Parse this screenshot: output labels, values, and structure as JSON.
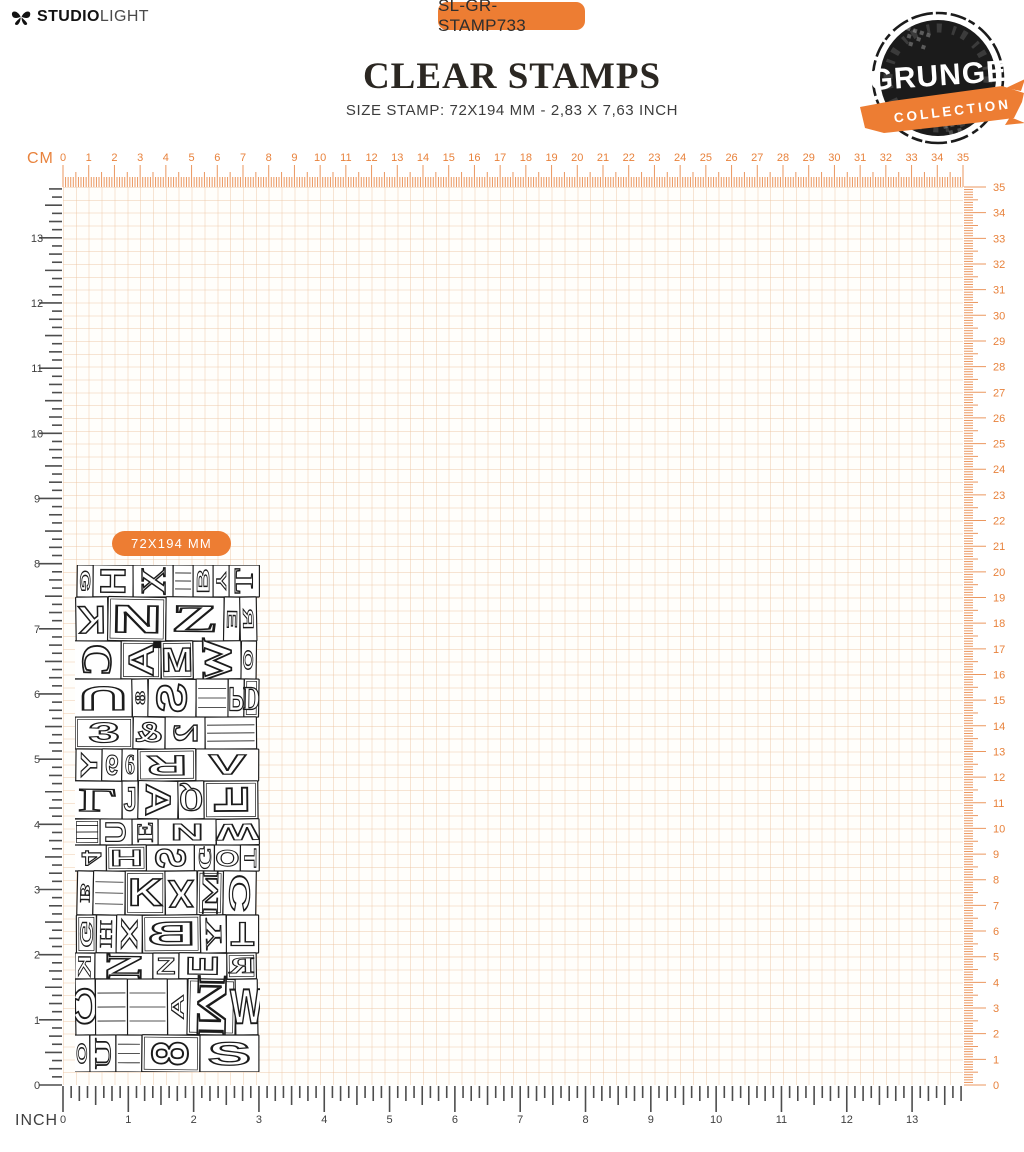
{
  "header": {
    "brand": {
      "bold": "STUDIO",
      "light": "LIGHT"
    },
    "product_code": "SL-GR-STAMP733",
    "title": "CLEAR STAMPS",
    "subtitle": "SIZE STAMP: 72X194 MM - 2,83 X 7,63 INCH"
  },
  "collection_logo": {
    "name": "GRUNGE",
    "sub": "COLLECTION"
  },
  "rulers": {
    "cm_label": "CM",
    "inch_label": "INCH",
    "cm_numbers": [
      0,
      1,
      2,
      3,
      4,
      5,
      6,
      7,
      8,
      9,
      10,
      11,
      12,
      13,
      14,
      15,
      16,
      17,
      18,
      19,
      20,
      21,
      22,
      23,
      24,
      25,
      26,
      27,
      28,
      29,
      30,
      31,
      32,
      33,
      34,
      35
    ],
    "inch_numbers": [
      0,
      1,
      2,
      3,
      4,
      5,
      6,
      7,
      8,
      9,
      10,
      11,
      12,
      13
    ]
  },
  "stamp": {
    "size_badge": "72X194 MM",
    "letters": "GHXBYTKNZERCAMWOU8SPD3&2Y96RVLJAQFUENW4HSGOTBKXMC"
  },
  "colors": {
    "accent": "#ED7D33",
    "ruler_tick": "#EB975F",
    "ruler_num": "#E8823C",
    "dark_tick": "#4d4d4d",
    "dark_num": "#3f3f3f",
    "grid_line": "#F5E5D4",
    "ink": "#1b1b1b"
  }
}
